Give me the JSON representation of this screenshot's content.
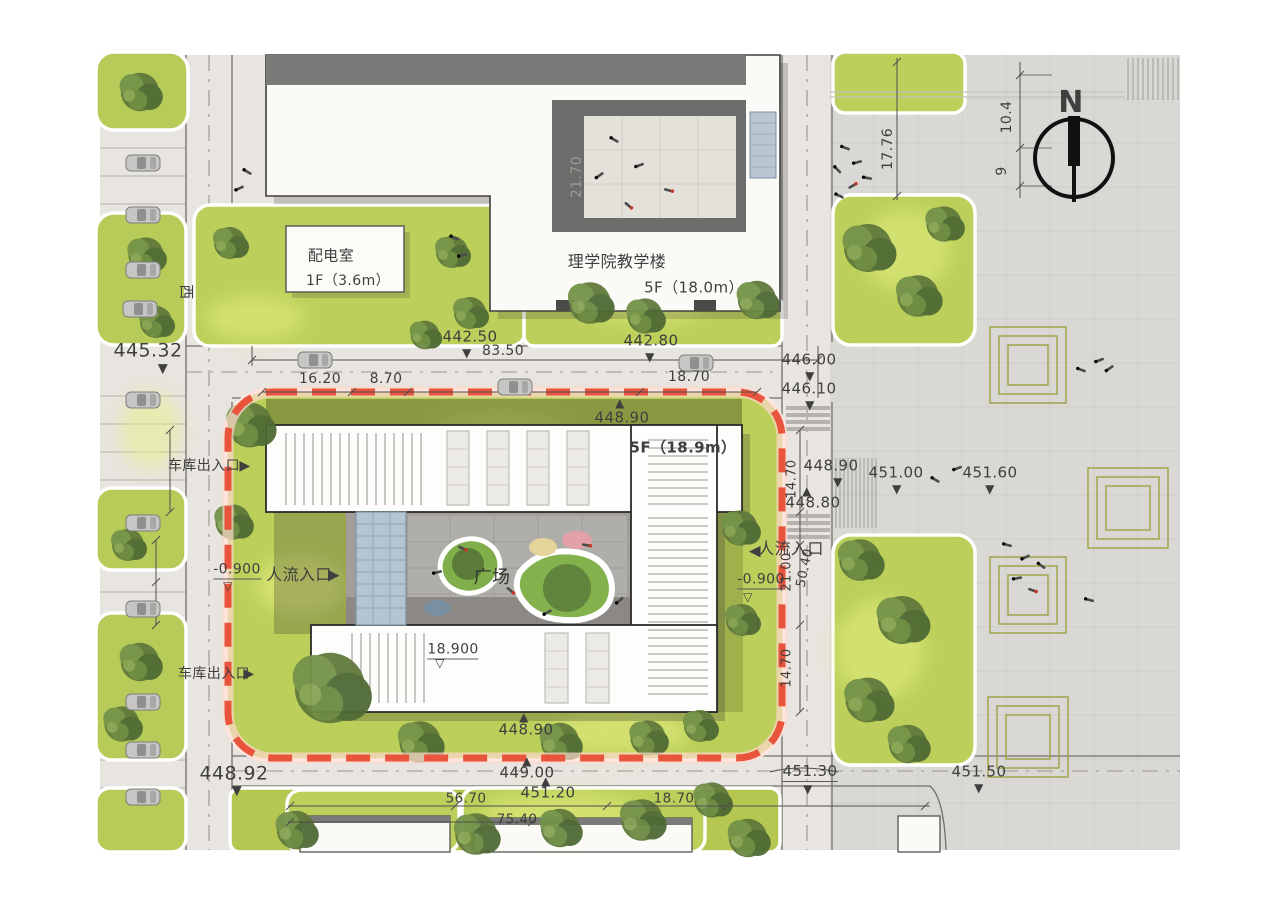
{
  "site": {
    "north_arrow_label": "N",
    "street_label": "西",
    "plaza_label": "广场",
    "boundary_color": "#e8543c",
    "buildings": [
      {
        "name": "power-distribution-room",
        "label": "配电室",
        "floors": "1F（3.6m）"
      },
      {
        "name": "science-college-teaching-building",
        "label": "理学院教学楼",
        "floors": "5F（18.0m）"
      },
      {
        "name": "main-building",
        "label": "",
        "floors": "5F（18.9m）"
      }
    ],
    "entrances": [
      {
        "label": "车库出入口",
        "side": "west-north"
      },
      {
        "label": "人流入口",
        "side": "west"
      },
      {
        "label": "人流入口",
        "side": "east"
      },
      {
        "label": "车库出入口",
        "side": "west-south"
      }
    ],
    "spot_elevations": [
      "445.32",
      "442.50",
      "442.80",
      "446.00",
      "446.10",
      "448.90",
      "448.90",
      "448.80",
      "451.00",
      "451.60",
      "448.90",
      "449.00",
      "451.20",
      "451.30",
      "451.50",
      "448.92",
      "18.900",
      "-0.900",
      "-0.900"
    ],
    "dimensions": [
      "83.50",
      "16.20",
      "8.70",
      "18.70",
      "21.70",
      "17.76",
      "10.4",
      "9",
      "14.70",
      "21.00",
      "50.40",
      "14.70",
      "56.70",
      "75.40",
      "18.70"
    ]
  },
  "colors": {
    "lawn": "#bccf5a",
    "lawn_glow": "#e9f285",
    "tree": "#5f7a3c",
    "road": "#e8e4df",
    "plaza": "#dad8d4",
    "building": "#fcfbf8",
    "roof_band": "#767674",
    "courtyard_paving": "#a29f9b",
    "glass": "#b3c4d2",
    "boundary_red": "#e8543c",
    "dim_text": "#3f3f3f"
  },
  "annotations": {
    "labels": [
      {
        "name": "street-name-west",
        "text": "西",
        "x": 186,
        "y": 292,
        "size": 15,
        "rotate": 90
      },
      {
        "name": "spot-elevation",
        "text": "445.32",
        "x": 148,
        "y": 351,
        "size": 19
      },
      {
        "name": "spot-marker-down",
        "text": "▼",
        "x": 163,
        "y": 369,
        "size": 13
      },
      {
        "name": "spot-elevation",
        "text": "442.50",
        "x": 470,
        "y": 337,
        "size": 15
      },
      {
        "name": "spot-marker-down",
        "text": "▼",
        "x": 467,
        "y": 353,
        "size": 12
      },
      {
        "name": "spot-elevation",
        "text": "442.80",
        "x": 651,
        "y": 341,
        "size": 15
      },
      {
        "name": "spot-marker-down",
        "text": "▼",
        "x": 650,
        "y": 357,
        "size": 12
      },
      {
        "name": "dimension",
        "text": "83.50",
        "x": 503,
        "y": 351,
        "size": 14
      },
      {
        "name": "dimension",
        "text": "16.20",
        "x": 320,
        "y": 379,
        "size": 14
      },
      {
        "name": "dimension",
        "text": "8.70",
        "x": 386,
        "y": 379,
        "size": 14
      },
      {
        "name": "dimension",
        "text": "18.70",
        "x": 689,
        "y": 377,
        "size": 14
      },
      {
        "name": "spot-elevation",
        "text": "446.00",
        "x": 809,
        "y": 360,
        "size": 15
      },
      {
        "name": "spot-marker-down",
        "text": "▼",
        "x": 810,
        "y": 376,
        "size": 12
      },
      {
        "name": "spot-elevation",
        "text": "446.10",
        "x": 809,
        "y": 389,
        "size": 15
      },
      {
        "name": "spot-marker-down",
        "text": "▼",
        "x": 810,
        "y": 405,
        "size": 12
      },
      {
        "name": "spot-marker-up",
        "text": "▲",
        "x": 620,
        "y": 403,
        "size": 12
      },
      {
        "name": "spot-elevation",
        "text": "448.90",
        "x": 622,
        "y": 418,
        "size": 15
      },
      {
        "name": "building-floors-label",
        "text": "5F（18.9m）",
        "x": 683,
        "y": 448,
        "size": 15,
        "bold": true
      },
      {
        "name": "dimension",
        "text": "14.70",
        "x": 792,
        "y": 479,
        "size": 13,
        "rotate": -90
      },
      {
        "name": "spot-elevation",
        "text": "448.90",
        "x": 831,
        "y": 466,
        "size": 15
      },
      {
        "name": "spot-marker-down",
        "text": "▼",
        "x": 838,
        "y": 482,
        "size": 12
      },
      {
        "name": "spot-marker-up",
        "text": "▲",
        "x": 807,
        "y": 491,
        "size": 12
      },
      {
        "name": "spot-elevation",
        "text": "448.80",
        "x": 813,
        "y": 503,
        "size": 15
      },
      {
        "name": "spot-elevation",
        "text": "451.00",
        "x": 896,
        "y": 473,
        "size": 15
      },
      {
        "name": "spot-marker-down",
        "text": "▼",
        "x": 897,
        "y": 489,
        "size": 12
      },
      {
        "name": "spot-elevation",
        "text": "451.60",
        "x": 990,
        "y": 473,
        "size": 15
      },
      {
        "name": "spot-marker-down",
        "text": "▼",
        "x": 990,
        "y": 489,
        "size": 12
      },
      {
        "name": "garage-entrance-label",
        "text": "车库出入口",
        "x": 204,
        "y": 466,
        "size": 14
      },
      {
        "name": "entrance-arrow",
        "text": "▶",
        "x": 245,
        "y": 466,
        "size": 14
      },
      {
        "name": "pedestrian-entrance-label",
        "text": "人流入口",
        "x": 299,
        "y": 575,
        "size": 16
      },
      {
        "name": "entrance-arrow",
        "text": "▶",
        "x": 334,
        "y": 575,
        "size": 15
      },
      {
        "name": "spot-elevation",
        "text": "-0.900",
        "x": 237,
        "y": 571,
        "size": 14,
        "underline": true
      },
      {
        "name": "spot-marker-open",
        "text": "▽",
        "x": 228,
        "y": 586,
        "size": 12
      },
      {
        "name": "entrance-arrow",
        "text": "◀",
        "x": 755,
        "y": 551,
        "size": 15
      },
      {
        "name": "pedestrian-entrance-label",
        "text": "人流入口",
        "x": 791,
        "y": 549,
        "size": 16
      },
      {
        "name": "spot-elevation",
        "text": "-0.900",
        "x": 761,
        "y": 581,
        "size": 14,
        "underline": true
      },
      {
        "name": "spot-marker-open",
        "text": "▽",
        "x": 748,
        "y": 597,
        "size": 12
      },
      {
        "name": "dimension",
        "text": "21.00",
        "x": 787,
        "y": 572,
        "size": 13,
        "rotate": -90
      },
      {
        "name": "dimension",
        "text": "50.40",
        "x": 805,
        "y": 568,
        "size": 13,
        "rotate": -78
      },
      {
        "name": "dimension",
        "text": "14.70",
        "x": 787,
        "y": 668,
        "size": 13,
        "rotate": -90
      },
      {
        "name": "plaza-label",
        "text": "广场",
        "x": 492,
        "y": 578,
        "size": 18,
        "color": "#333330"
      },
      {
        "name": "spot-elevation",
        "text": "18.900",
        "x": 453,
        "y": 651,
        "size": 14,
        "underline": true
      },
      {
        "name": "spot-marker-open",
        "text": "▽",
        "x": 440,
        "y": 663,
        "size": 12
      },
      {
        "name": "garage-entrance-label",
        "text": "车库出入口",
        "x": 214,
        "y": 674,
        "size": 14
      },
      {
        "name": "entrance-arrow",
        "text": "▶",
        "x": 249,
        "y": 674,
        "size": 14
      },
      {
        "name": "spot-elevation",
        "text": "448.92",
        "x": 234,
        "y": 774,
        "size": 19
      },
      {
        "name": "spot-marker-down",
        "text": "▼",
        "x": 237,
        "y": 791,
        "size": 13
      },
      {
        "name": "spot-marker-up",
        "text": "▲",
        "x": 524,
        "y": 717,
        "size": 12
      },
      {
        "name": "spot-elevation",
        "text": "448.90",
        "x": 526,
        "y": 730,
        "size": 15
      },
      {
        "name": "spot-marker-up",
        "text": "▲",
        "x": 527,
        "y": 761,
        "size": 12
      },
      {
        "name": "spot-elevation",
        "text": "449.00",
        "x": 527,
        "y": 773,
        "size": 15
      },
      {
        "name": "spot-marker-up",
        "text": "▲",
        "x": 546,
        "y": 781,
        "size": 12
      },
      {
        "name": "spot-elevation",
        "text": "451.20",
        "x": 548,
        "y": 793,
        "size": 15
      },
      {
        "name": "spot-elevation",
        "text": "451.30",
        "x": 810,
        "y": 773,
        "size": 15,
        "underline": true
      },
      {
        "name": "spot-marker-down",
        "text": "▼",
        "x": 808,
        "y": 789,
        "size": 12
      },
      {
        "name": "spot-elevation",
        "text": "451.50",
        "x": 979,
        "y": 772,
        "size": 15
      },
      {
        "name": "spot-marker-down",
        "text": "▼",
        "x": 979,
        "y": 788,
        "size": 12
      },
      {
        "name": "dimension",
        "text": "56.70",
        "x": 466,
        "y": 799,
        "size": 13.5
      },
      {
        "name": "dimension",
        "text": "75.40",
        "x": 517,
        "y": 820,
        "size": 13.5
      },
      {
        "name": "dimension",
        "text": "18.70",
        "x": 674,
        "y": 799,
        "size": 13.5
      },
      {
        "name": "power-room-label",
        "text": "配电室",
        "x": 331,
        "y": 256,
        "size": 15
      },
      {
        "name": "power-room-floors",
        "text": "1F（3.6m）",
        "x": 348,
        "y": 281,
        "size": 14
      },
      {
        "name": "teaching-building-label",
        "text": "理学院教学楼",
        "x": 617,
        "y": 262,
        "size": 16
      },
      {
        "name": "teaching-building-floors",
        "text": "5F（18.0m）",
        "x": 694,
        "y": 288,
        "size": 15
      },
      {
        "name": "dimension",
        "text": "21.70",
        "x": 577,
        "y": 177,
        "size": 14,
        "rotate": -90,
        "color": "#9a9a96"
      },
      {
        "name": "dimension",
        "text": "17.76",
        "x": 888,
        "y": 149,
        "size": 14,
        "rotate": -90
      },
      {
        "name": "dimension",
        "text": "10.4",
        "x": 1007,
        "y": 117,
        "size": 14,
        "rotate": -90
      },
      {
        "name": "dimension",
        "text": "9",
        "x": 1002,
        "y": 171,
        "size": 14,
        "rotate": -90
      },
      {
        "name": "north-letter",
        "text": "N",
        "x": 1071,
        "y": 103,
        "size": 30,
        "bold": true
      }
    ]
  }
}
